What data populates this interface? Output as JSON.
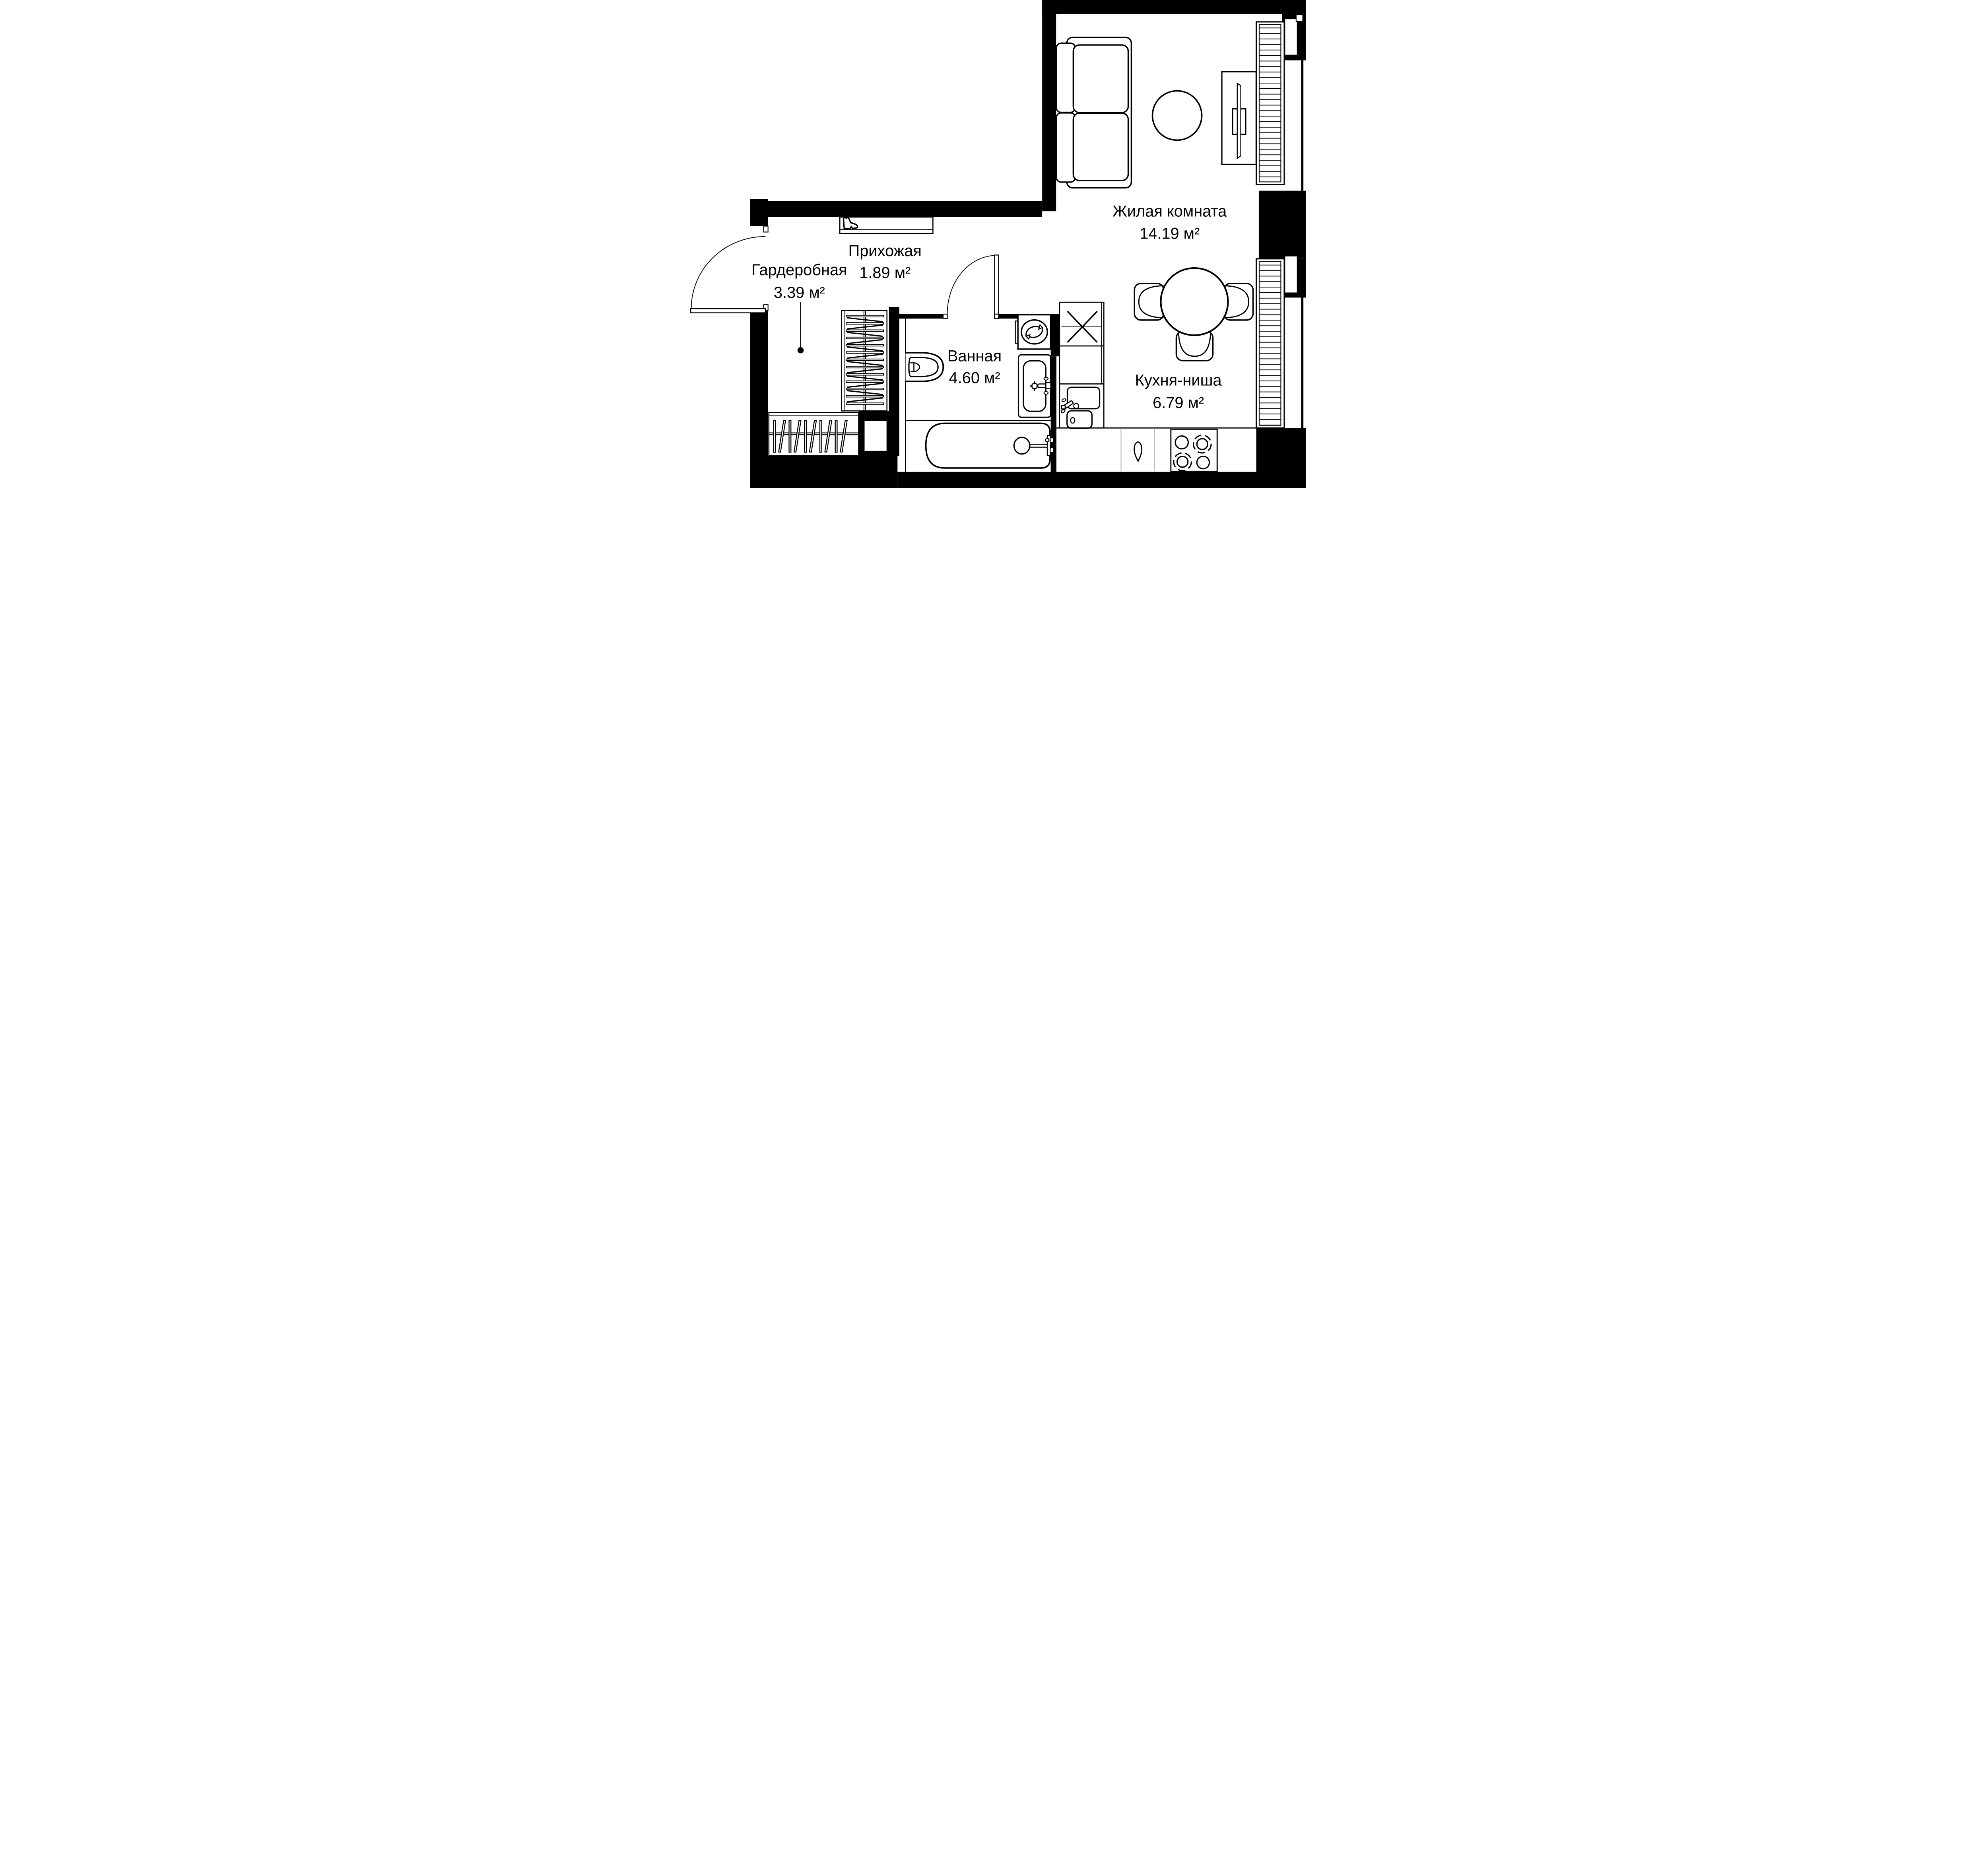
{
  "floorplan": {
    "type": "apartment-studio-plan",
    "background_color": "#ffffff",
    "wall_color": "#000000",
    "line_color": "#000000",
    "counter_divider_color": "#b3b3b3",
    "rooms": [
      {
        "id": "living",
        "name": "Жилая комната",
        "area": "14.19 м²"
      },
      {
        "id": "hallway",
        "name": "Прихожая",
        "area": "1.89 м²"
      },
      {
        "id": "wardrobe",
        "name": "Гардеробная",
        "area": "3.39 м²"
      },
      {
        "id": "bathroom",
        "name": "Ванная",
        "area": "4.60 м²"
      },
      {
        "id": "kitchen",
        "name": "Кухня-ниша",
        "area": "6.79 м²"
      }
    ],
    "fixtures": [
      "sofa",
      "rug",
      "tv-console",
      "window",
      "radiator-hatch",
      "dining-table",
      "chair",
      "kitchen-sink",
      "vent-shaft",
      "stove",
      "cabinet-handle",
      "washing-machine",
      "bathroom-sink",
      "toilet",
      "bathtub",
      "shoe-shelf",
      "clothes-rack",
      "door-swing",
      "area-leader-dot"
    ]
  }
}
